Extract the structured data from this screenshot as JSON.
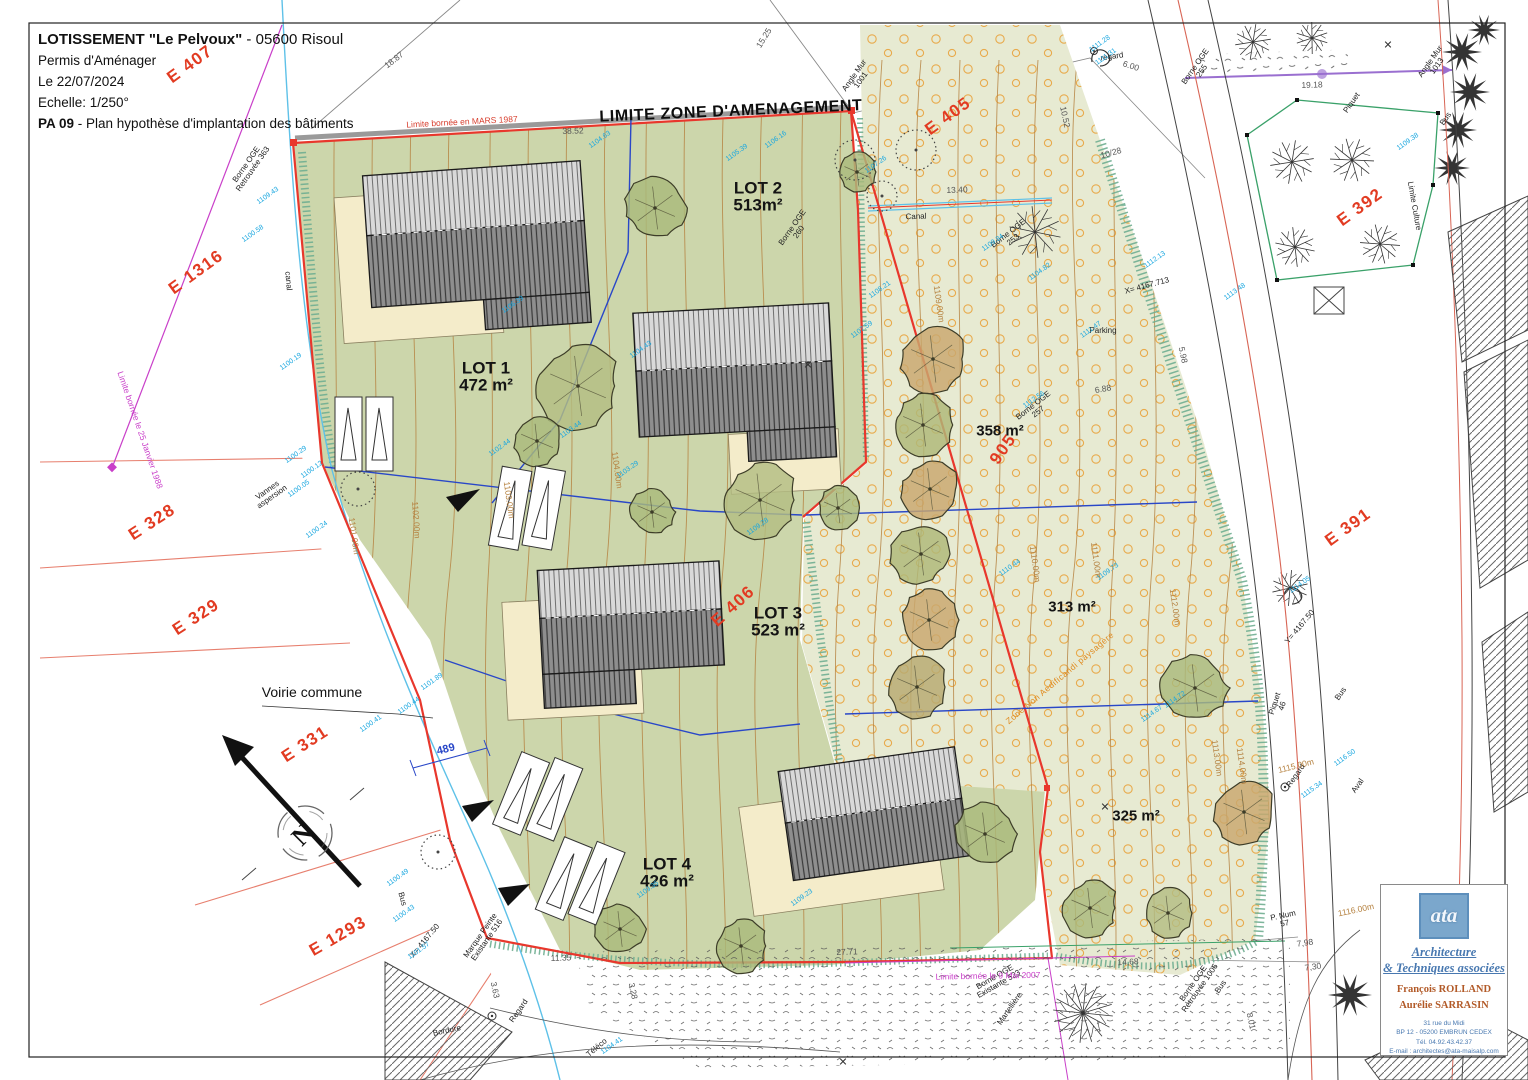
{
  "title_block": {
    "line1_bold": "LOTISSEMENT  \"Le Pelvoux\"",
    "line1_rest": " - 05600 Risoul",
    "line2": "Permis d'Aménager",
    "line3": "Le 22/07/2024",
    "line4": "Echelle: 1/250°",
    "line5_bold": "PA 09",
    "line5_rest": " - Plan hypothèse d'implantation des bâtiments"
  },
  "logo": {
    "mark": "ata",
    "studio_line1": "Architecture",
    "studio_line2": "& Techniques associées",
    "architect1": "François ROLLAND",
    "architect2": "Aurélie SARRASIN",
    "address1": "31 rue du Midi",
    "address2": "BP 12 - 05200 EMBRUN CEDEX",
    "address3": "Tél. 04.92.43.42.37",
    "address4": "E-mail : architectes@ata-maisalp.com"
  },
  "colors": {
    "parcel_red": "#e23b22",
    "zone_boundary_red": "#e8372c",
    "lot_division_blue": "#2947c8",
    "canal_cyan": "#5ec1e8",
    "limit_magenta": "#c93fc9",
    "contour_brown": "#b5813f",
    "irrigation_orange": "#e8a33d",
    "lots_green": "#ccd6ab",
    "meadow_green": "#e7ead2"
  },
  "map": {
    "labels": [
      {
        "t": "E 407",
        "x": 190,
        "y": 64,
        "r": -36,
        "c": "red"
      },
      {
        "t": "E 405",
        "x": 948,
        "y": 116,
        "r": -36,
        "c": "red"
      },
      {
        "t": "E 392",
        "x": 1360,
        "y": 207,
        "r": -36,
        "c": "red"
      },
      {
        "t": "E 1316",
        "x": 196,
        "y": 272,
        "r": -36,
        "c": "red"
      },
      {
        "t": "E 328",
        "x": 152,
        "y": 522,
        "r": -33,
        "c": "red"
      },
      {
        "t": "E 329",
        "x": 196,
        "y": 617,
        "r": -33,
        "c": "red"
      },
      {
        "t": "E 331",
        "x": 305,
        "y": 744,
        "r": -33,
        "c": "red"
      },
      {
        "t": "E 1293",
        "x": 338,
        "y": 936,
        "r": -30,
        "c": "red"
      },
      {
        "t": "E 391",
        "x": 1348,
        "y": 527,
        "r": -36,
        "c": "red"
      },
      {
        "t": "E 406",
        "x": 733,
        "y": 606,
        "r": -42,
        "c": "red"
      },
      {
        "t": "905",
        "x": 1003,
        "y": 449,
        "r": -55,
        "c": "red"
      },
      {
        "t": "LIMITE ZONE D'AMENAGEMENT",
        "x": 731,
        "y": 112,
        "r": -2.5,
        "c": "limite"
      },
      {
        "t": "LOT 2",
        "t2": "513m²",
        "x": 758,
        "y": 197,
        "r": 0,
        "c": "lot"
      },
      {
        "t": "LOT 1",
        "t2": "472 m²",
        "x": 486,
        "y": 377,
        "r": 0,
        "c": "lot"
      },
      {
        "t": "LOT 3",
        "t2": "523 m²",
        "x": 778,
        "y": 622,
        "r": 0,
        "c": "lot"
      },
      {
        "t": "LOT 4",
        "t2": "426 m²",
        "x": 667,
        "y": 873,
        "r": 0,
        "c": "lot"
      },
      {
        "t": "358 m²",
        "x": 1000,
        "y": 431,
        "r": 0,
        "c": "area"
      },
      {
        "t": "313 m²",
        "x": 1072,
        "y": 607,
        "r": 0,
        "c": "area"
      },
      {
        "t": "325 m²",
        "x": 1136,
        "y": 816,
        "r": 0,
        "c": "area"
      },
      {
        "t": "Voirie commune",
        "x": 312,
        "y": 692,
        "r": 0,
        "c": "sm"
      },
      {
        "t": "Canal",
        "x": 916,
        "y": 217,
        "r": -2,
        "c": "xs"
      },
      {
        "t": "canal",
        "x": 288,
        "y": 281,
        "r": 85,
        "c": "xs"
      },
      {
        "t": "Bordure",
        "x": 447,
        "y": 1031,
        "r": -12,
        "c": "xs"
      },
      {
        "t": "Téléco",
        "x": 597,
        "y": 1048,
        "r": -40,
        "c": "xs"
      },
      {
        "t": "Bus",
        "x": 402,
        "y": 899,
        "r": 75,
        "c": "xs"
      },
      {
        "t": "Bus",
        "x": 1446,
        "y": 119,
        "r": -55,
        "c": "xs"
      },
      {
        "t": "Bus",
        "x": 1341,
        "y": 694,
        "r": -55,
        "c": "xs"
      },
      {
        "t": "Bus",
        "x": 1221,
        "y": 987,
        "r": -55,
        "c": "xs"
      },
      {
        "t": "regard",
        "x": 1112,
        "y": 57,
        "r": -8,
        "c": "xs"
      },
      {
        "t": "Regard",
        "x": 1296,
        "y": 776,
        "r": -55,
        "c": "xs"
      },
      {
        "t": "Regard",
        "x": 519,
        "y": 1011,
        "r": -55,
        "c": "xs"
      },
      {
        "t": "Aval",
        "x": 1358,
        "y": 786,
        "r": -55,
        "c": "xs"
      },
      {
        "t": "Piquet",
        "x": 1352,
        "y": 103,
        "r": -55,
        "c": "xs"
      },
      {
        "t": "Angle Mur",
        "t2": "1013",
        "x": 1434,
        "y": 64,
        "r": -55,
        "c": "xs"
      },
      {
        "t": "Angle Mur",
        "t2": "1001",
        "x": 858,
        "y": 78,
        "r": -55,
        "c": "xs"
      },
      {
        "t": "Limite Culture",
        "x": 1414,
        "y": 206,
        "r": 80,
        "c": "xs"
      },
      {
        "t": "Parking",
        "x": 1103,
        "y": 331,
        "r": 0,
        "c": "xs"
      },
      {
        "t": "P. Num",
        "t2": "57",
        "x": 1284,
        "y": 920,
        "r": -12,
        "c": "xs"
      },
      {
        "t": "Piquet",
        "t2": "46",
        "x": 1279,
        "y": 705,
        "r": -72,
        "c": "xs"
      },
      {
        "t": "Vannes",
        "t2": "aspersion",
        "x": 270,
        "y": 494,
        "r": -35,
        "c": "xs"
      },
      {
        "t": "Marque Peinte",
        "t2": "Existante 516",
        "x": 484,
        "y": 938,
        "r": -55,
        "c": "xs"
      },
      {
        "t": "Borne OGE",
        "t2": "Existante 523",
        "x": 997,
        "y": 981,
        "r": -30,
        "c": "xs"
      },
      {
        "t": "Borne OGE",
        "t2": "Retrouvée 1006",
        "x": 1197,
        "y": 986,
        "r": -55,
        "c": "xs"
      },
      {
        "t": "Borne OGE",
        "t2": "Retrouvée 363",
        "x": 250,
        "y": 167,
        "r": -55,
        "c": "xs"
      },
      {
        "t": "Borne OGE",
        "t2": "253",
        "x": 1011,
        "y": 237,
        "r": -38,
        "c": "xs"
      },
      {
        "t": "Borne OGE",
        "t2": "255",
        "x": 1199,
        "y": 69,
        "r": -55,
        "c": "xs"
      },
      {
        "t": "Borne OGE",
        "t2": "260",
        "x": 796,
        "y": 230,
        "r": -55,
        "c": "xs"
      },
      {
        "t": "Borne OGE",
        "t2": "257",
        "x": 1036,
        "y": 409,
        "r": -38,
        "c": "xs"
      },
      {
        "t": "Martellière",
        "x": 1010,
        "y": 1009,
        "r": -55,
        "c": "xs"
      },
      {
        "t": "Limite bornée le 25 Janvier 1988",
        "x": 140,
        "y": 430,
        "r": 71,
        "c": "mag"
      },
      {
        "t": "Limite bornée le 9 Mai 2007",
        "x": 988,
        "y": 976,
        "r": -1,
        "c": "mag"
      },
      {
        "t": "Limite bornée en MARS 1987",
        "x": 462,
        "y": 122,
        "r": -3,
        "c": "redsm"
      },
      {
        "t": "18.87",
        "x": 394,
        "y": 60,
        "r": -38,
        "c": "dim"
      },
      {
        "t": "15.25",
        "x": 764,
        "y": 38,
        "r": -58,
        "c": "dim"
      },
      {
        "t": "38.52",
        "x": 573,
        "y": 131,
        "r": -2,
        "c": "dim"
      },
      {
        "t": "13.40",
        "x": 957,
        "y": 190,
        "r": -2,
        "c": "dim"
      },
      {
        "t": "11.35",
        "x": 561,
        "y": 958,
        "r": -2,
        "c": "dim"
      },
      {
        "t": "27.71",
        "x": 847,
        "y": 952,
        "r": -2,
        "c": "dim"
      },
      {
        "t": "14,68",
        "x": 1128,
        "y": 962,
        "r": -3,
        "c": "dim"
      },
      {
        "t": "7,98",
        "x": 1305,
        "y": 943,
        "r": -8,
        "c": "dim"
      },
      {
        "t": "7,30",
        "x": 1313,
        "y": 967,
        "r": -8,
        "c": "dim"
      },
      {
        "t": "8.01",
        "x": 1251,
        "y": 1021,
        "r": 78,
        "c": "dim"
      },
      {
        "t": "19.18",
        "x": 1312,
        "y": 85,
        "r": -2,
        "c": "dim"
      },
      {
        "t": "10.52",
        "x": 1065,
        "y": 117,
        "r": 78,
        "c": "dim"
      },
      {
        "t": "10/28",
        "x": 1111,
        "y": 153,
        "r": -15,
        "c": "dim"
      },
      {
        "t": "6.00",
        "x": 1131,
        "y": 66,
        "r": 18,
        "c": "dim"
      },
      {
        "t": "5.98",
        "x": 1183,
        "y": 355,
        "r": 78,
        "c": "dim"
      },
      {
        "t": "6.88",
        "x": 1103,
        "y": 389,
        "r": -10,
        "c": "dim"
      },
      {
        "t": "3.28",
        "x": 633,
        "y": 991,
        "r": 78,
        "c": "dim"
      },
      {
        "t": "3.63",
        "x": 495,
        "y": 990,
        "r": 78,
        "c": "dim"
      },
      {
        "t": "X= 4167.50",
        "x": 425,
        "y": 941,
        "r": -50,
        "c": "xs"
      },
      {
        "t": "Y= 4167.50",
        "x": 1300,
        "y": 627,
        "r": -50,
        "c": "xs"
      },
      {
        "t": "X= 4167.713",
        "x": 1147,
        "y": 286,
        "r": -15,
        "c": "xs"
      },
      {
        "t": "489",
        "x": 446,
        "y": 750,
        "r": -15,
        "c": "blue"
      },
      {
        "t": "1101.00m",
        "x": 354,
        "y": 536,
        "r": 82,
        "c": "contour"
      },
      {
        "t": "1102.00m",
        "x": 416,
        "y": 520,
        "r": 86,
        "c": "contour"
      },
      {
        "t": "1103.00m",
        "x": 509,
        "y": 500,
        "r": 82,
        "c": "contour"
      },
      {
        "t": "1104.00m",
        "x": 617,
        "y": 470,
        "r": 82,
        "c": "contour"
      },
      {
        "t": "1109.00m",
        "x": 939,
        "y": 304,
        "r": 82,
        "c": "contour"
      },
      {
        "t": "1110.00m",
        "x": 1035,
        "y": 564,
        "r": 82,
        "c": "contour"
      },
      {
        "t": "1111.00m",
        "x": 1096,
        "y": 560,
        "r": 82,
        "c": "contour"
      },
      {
        "t": "1112.00m",
        "x": 1175,
        "y": 607,
        "r": 82,
        "c": "contour"
      },
      {
        "t": "1113.00m",
        "x": 1217,
        "y": 758,
        "r": 82,
        "c": "contour"
      },
      {
        "t": "1114.00m",
        "x": 1242,
        "y": 766,
        "r": 82,
        "c": "contour"
      },
      {
        "t": "1115.00m",
        "x": 1296,
        "y": 766,
        "r": -14,
        "c": "contour"
      },
      {
        "t": "1116.00m",
        "x": 1356,
        "y": 910,
        "r": -12,
        "c": "contour"
      },
      {
        "t": "Zone Non Aedificandi paysagère",
        "x": 1060,
        "y": 678,
        "r": -40,
        "c": "orange"
      },
      {
        "t": "N",
        "x": 303,
        "y": 835,
        "r": -45,
        "c": "north"
      },
      {
        "t": "✕",
        "x": 808,
        "y": 366,
        "r": 0,
        "c": "xm"
      },
      {
        "t": "✕",
        "x": 1388,
        "y": 46,
        "r": 0,
        "c": "xm"
      },
      {
        "t": "✕",
        "x": 843,
        "y": 1063,
        "r": 0,
        "c": "xm"
      },
      {
        "t": "✕",
        "x": 1105,
        "y": 808,
        "r": 0,
        "c": "xm"
      },
      {
        "t": "1109.43",
        "x": 268,
        "y": 196,
        "r": -35,
        "c": "spot"
      },
      {
        "t": "1100.58",
        "x": 253,
        "y": 234,
        "r": -35,
        "c": "spot"
      },
      {
        "t": "1100.19",
        "x": 291,
        "y": 362,
        "r": -35,
        "c": "spot"
      },
      {
        "t": "1100.29",
        "x": 296,
        "y": 455,
        "r": -35,
        "c": "spot"
      },
      {
        "t": "1100.12",
        "x": 312,
        "y": 470,
        "r": -35,
        "c": "spot"
      },
      {
        "t": "1100.05",
        "x": 299,
        "y": 489,
        "r": -35,
        "c": "spot"
      },
      {
        "t": "1100.24",
        "x": 317,
        "y": 530,
        "r": -35,
        "c": "spot"
      },
      {
        "t": "1101.89",
        "x": 432,
        "y": 682,
        "r": -35,
        "c": "spot"
      },
      {
        "t": "1100.44",
        "x": 409,
        "y": 706,
        "r": -35,
        "c": "spot"
      },
      {
        "t": "1100.41",
        "x": 371,
        "y": 724,
        "r": -35,
        "c": "spot"
      },
      {
        "t": "1100.49",
        "x": 398,
        "y": 878,
        "r": -35,
        "c": "spot"
      },
      {
        "t": "1100.43",
        "x": 404,
        "y": 914,
        "r": -35,
        "c": "spot"
      },
      {
        "t": "1101.57",
        "x": 419,
        "y": 951,
        "r": -35,
        "c": "spot"
      },
      {
        "t": "1104.63",
        "x": 600,
        "y": 140,
        "r": -35,
        "c": "spot"
      },
      {
        "t": "1106.16",
        "x": 776,
        "y": 140,
        "r": -35,
        "c": "spot"
      },
      {
        "t": "1105.39",
        "x": 737,
        "y": 153,
        "r": -35,
        "c": "spot"
      },
      {
        "t": "1106.39",
        "x": 513,
        "y": 305,
        "r": -35,
        "c": "spot"
      },
      {
        "t": "1104.43",
        "x": 641,
        "y": 350,
        "r": -35,
        "c": "spot"
      },
      {
        "t": "1103.44",
        "x": 571,
        "y": 430,
        "r": -35,
        "c": "spot"
      },
      {
        "t": "1103.29",
        "x": 628,
        "y": 470,
        "r": -35,
        "c": "spot"
      },
      {
        "t": "1102.44",
        "x": 500,
        "y": 448,
        "r": -35,
        "c": "spot"
      },
      {
        "t": "1107.26",
        "x": 876,
        "y": 165,
        "r": -35,
        "c": "spot"
      },
      {
        "t": "1108.21",
        "x": 880,
        "y": 290,
        "r": -35,
        "c": "spot"
      },
      {
        "t": "1109.84",
        "x": 993,
        "y": 243,
        "r": -35,
        "c": "spot"
      },
      {
        "t": "1110.44",
        "x": 1010,
        "y": 568,
        "r": -35,
        "c": "spot"
      },
      {
        "t": "1111.47",
        "x": 1091,
        "y": 330,
        "r": -35,
        "c": "spot"
      },
      {
        "t": "1112.56",
        "x": 1034,
        "y": 400,
        "r": -35,
        "c": "spot"
      },
      {
        "t": "1112.13",
        "x": 1155,
        "y": 260,
        "r": -35,
        "c": "spot"
      },
      {
        "t": "1113.48",
        "x": 1235,
        "y": 292,
        "r": -35,
        "c": "spot"
      },
      {
        "t": "1114.05",
        "x": 1300,
        "y": 585,
        "r": -35,
        "c": "spot"
      },
      {
        "t": "1115.34",
        "x": 1312,
        "y": 790,
        "r": -35,
        "c": "spot"
      },
      {
        "t": "1116.50",
        "x": 1345,
        "y": 758,
        "r": -35,
        "c": "spot"
      },
      {
        "t": "1109.73",
        "x": 1108,
        "y": 572,
        "r": -35,
        "c": "spot"
      },
      {
        "t": "1107.59",
        "x": 862,
        "y": 330,
        "r": -35,
        "c": "spot"
      },
      {
        "t": "1104.82",
        "x": 1040,
        "y": 272,
        "r": -35,
        "c": "spot"
      },
      {
        "t": "1111.28",
        "x": 1100,
        "y": 44,
        "r": -35,
        "c": "spot"
      },
      {
        "t": "1111.31",
        "x": 1106,
        "y": 57,
        "r": -35,
        "c": "spot"
      },
      {
        "t": "1109.38",
        "x": 1408,
        "y": 142,
        "r": -35,
        "c": "spot"
      },
      {
        "t": "1109.28",
        "x": 758,
        "y": 527,
        "r": -35,
        "c": "spot"
      },
      {
        "t": "1104.41",
        "x": 612,
        "y": 1046,
        "r": -35,
        "c": "spot"
      },
      {
        "t": "1109.35",
        "x": 648,
        "y": 890,
        "r": -35,
        "c": "spot"
      },
      {
        "t": "1109.23",
        "x": 802,
        "y": 898,
        "r": -35,
        "c": "spot"
      },
      {
        "t": "1114.67",
        "x": 1152,
        "y": 714,
        "r": -35,
        "c": "spot"
      },
      {
        "t": "1114.72",
        "x": 1175,
        "y": 700,
        "r": -35,
        "c": "spot"
      }
    ]
  }
}
